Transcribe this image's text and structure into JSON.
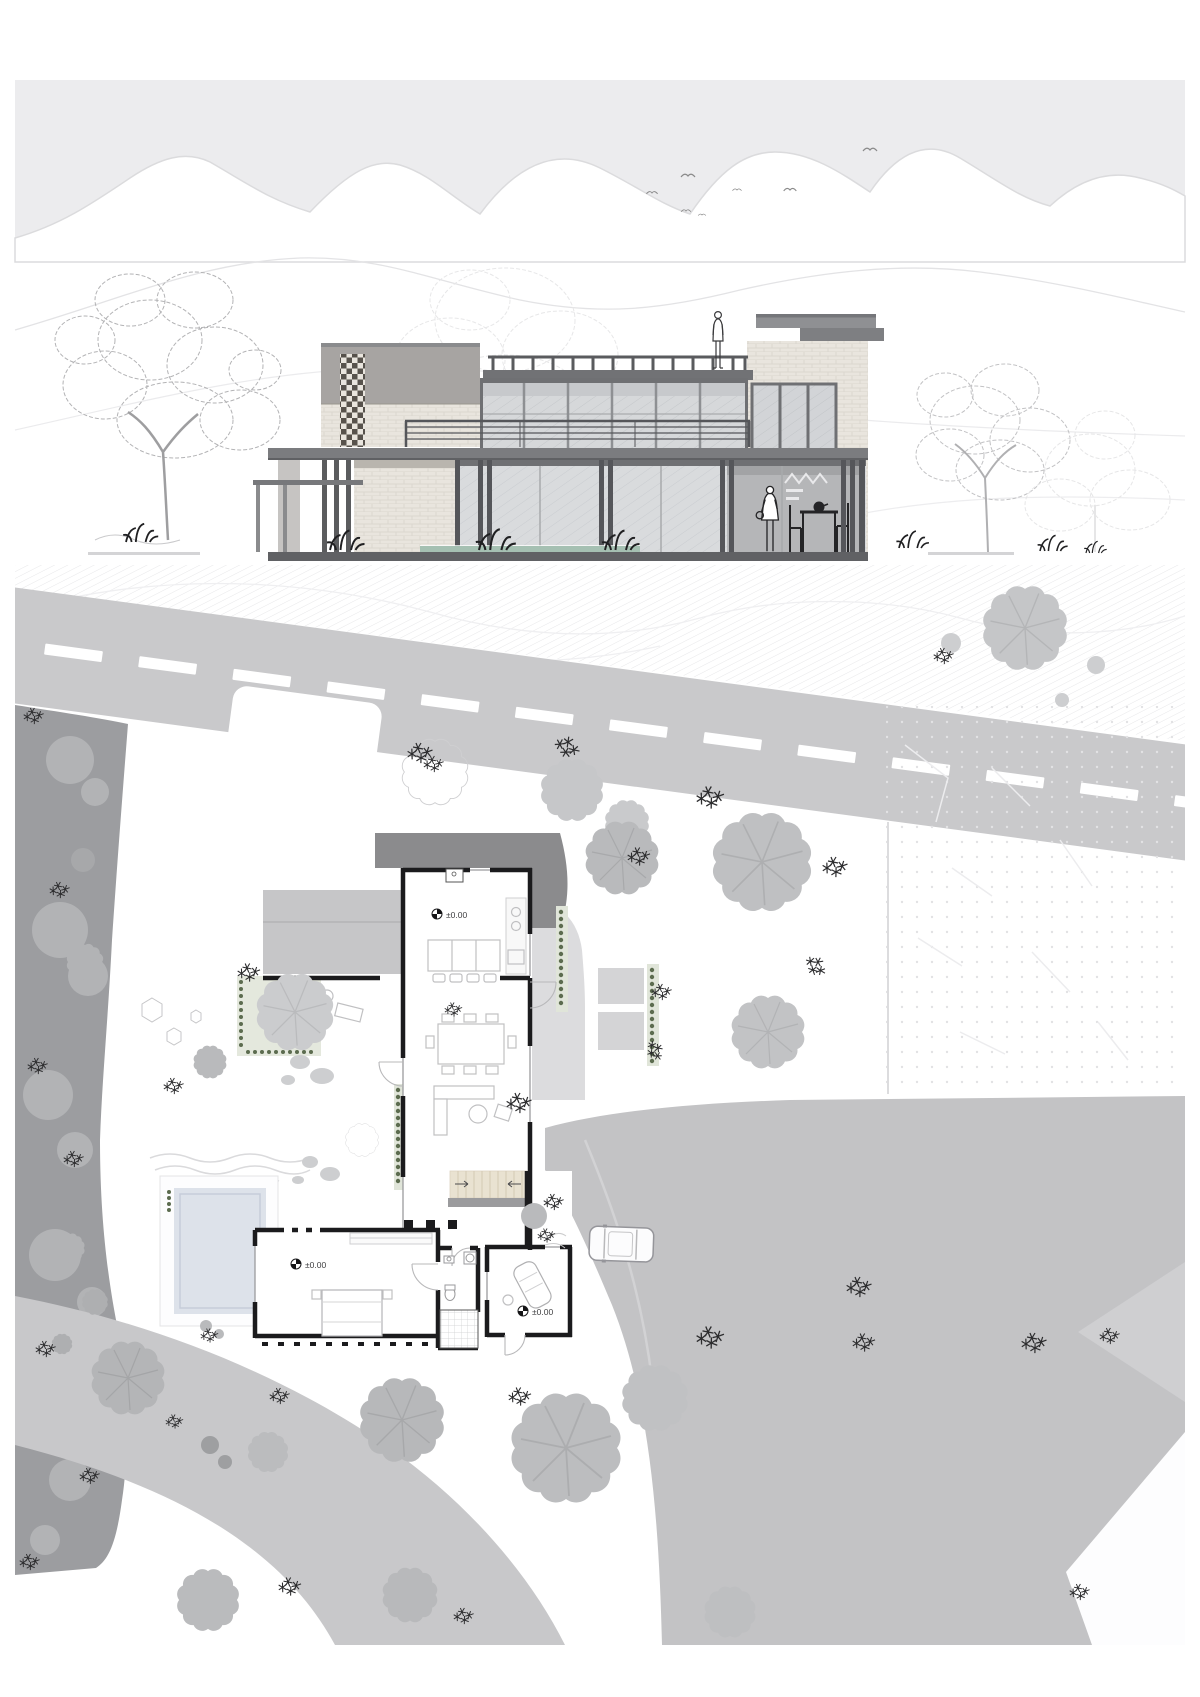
{
  "levels": {
    "kitchen": "±0.00",
    "bedroom": "±0.00",
    "study": "±0.00"
  },
  "colors": {
    "page_background": "#ffffff",
    "sky": "#ececee",
    "mountain_outline": "#d9d9db",
    "elevation_dark_frame": "#64656a",
    "elevation_gray_band": "#a7a4a2",
    "brick": "#e9e5de",
    "brick_screen_dark": "#57524c",
    "glass": "#d8dadc",
    "interior_back_wall": "#b5b6b8",
    "road": "#c9c9cb",
    "road_marking": "#ffffff",
    "site_dark_verge": "#9c9da0",
    "court_paving": "#c3c3c5",
    "roof_shadow": "#8b8b8d",
    "terrace_deck": "#c6c6c8",
    "tree_canopy": "#bfc0c2",
    "pool_water": "#dde2ea",
    "stair_wood": "#e9e2d1",
    "hedge_green": "#5c6c4f",
    "plan_wall": "#1b1b1d",
    "marker_text": "#3f3f41"
  }
}
